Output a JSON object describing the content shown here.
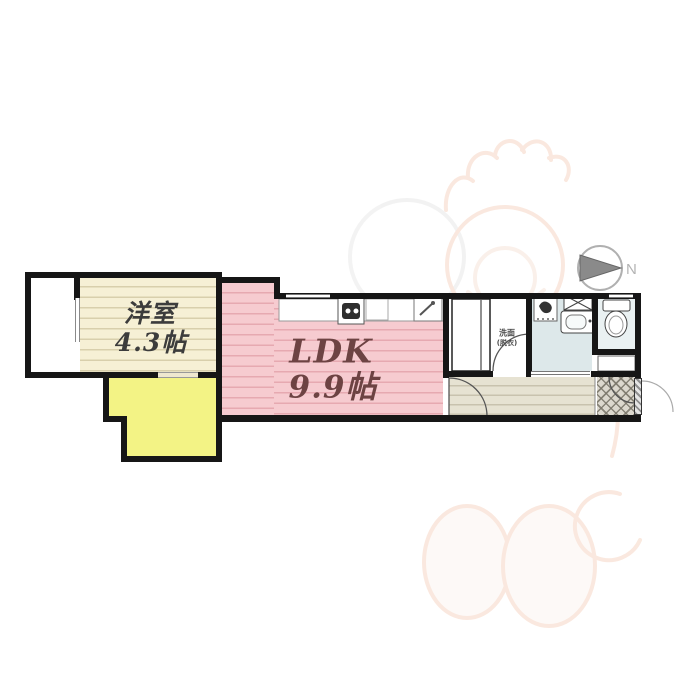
{
  "plan_type": "apartment-floorplan",
  "compass": {
    "label": "N",
    "direction": "north-points-right"
  },
  "rooms": {
    "western": {
      "name": "洋室",
      "size": "4.3帖"
    },
    "ldk": {
      "name": "LDK",
      "size": "9.9帖"
    },
    "washroom": {
      "name": "洗面",
      "note": "(脱衣)"
    }
  },
  "icons": {
    "compass-icon": "gray circle with right-pointing triangle and N",
    "stove-icon": "dark 2-burner stove square in kitchen counter",
    "sink-icon": "square with diagonal faucet in kitchen counter",
    "bath-fixture-icon": "small dark fixture glyph in bathroom",
    "washer-pan-icon": "rectangle with X cross",
    "vanity-sink-icon": "rounded basin with faucet dot",
    "toilet-icon": "tank and bowl top view",
    "closet-icon": "double sliding-door closet rectangle",
    "door-arc-icon": "quarter-circle door swings",
    "entrance-tile-icon": "diagonal crosshatch genkan tile",
    "mascot-watermark": "faint orange-outlined mascot character"
  },
  "colors": {
    "wall": "#161616",
    "ldk_pink": "#f6cbd0",
    "western_cream": "#f6f0d5",
    "yellow_area": "#f3f385",
    "bath_blue": "#dde8ea",
    "hall_beige": "#e6e2d2",
    "genkan_gray": "#dcd8ce",
    "ldk_text": "#6d4343",
    "compass_gray": "#8a8a8a",
    "watermark_orange": "#f1c0a4"
  }
}
